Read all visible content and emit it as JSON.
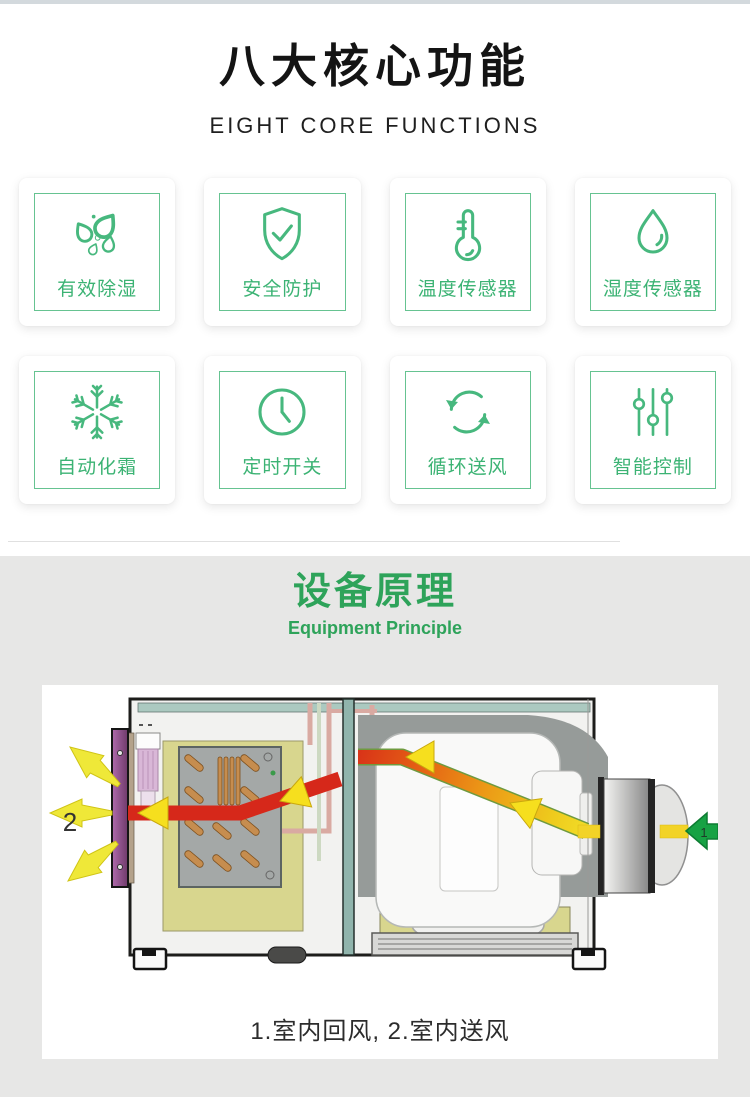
{
  "theme": {
    "accent_green": "#3cb374",
    "icon_stroke_green": "#47b87e",
    "card_border_green": "#66c391",
    "section_title_green": "#2ea35a",
    "top_strip": "#d3d9dd",
    "section_background": "#e7e7e6",
    "heading_color": "#141414",
    "flow_red": "#d6281a",
    "flow_orange": "#ee7f18",
    "flow_yellow": "#f2d327",
    "inlet_arrow_green": "#17a244",
    "louver_purple": "#9a4f96"
  },
  "header": {
    "title": "八大核心功能",
    "subtitle": "EIGHT CORE FUNCTIONS"
  },
  "features": {
    "cards": [
      {
        "icon": "droplets-icon",
        "label": "有效除湿"
      },
      {
        "icon": "shield-check-icon",
        "label": "安全防护"
      },
      {
        "icon": "thermometer-icon",
        "label": "温度传感器"
      },
      {
        "icon": "water-drop-icon",
        "label": "湿度传感器"
      },
      {
        "icon": "snowflake-icon",
        "label": "自动化霜"
      },
      {
        "icon": "clock-icon",
        "label": "定时开关"
      },
      {
        "icon": "cycle-arrows-icon",
        "label": "循环送风"
      },
      {
        "icon": "sliders-icon",
        "label": "智能控制"
      }
    ]
  },
  "principle": {
    "title": "设备原理",
    "subtitle": "Equipment Principle",
    "caption": "1.室内回风, 2.室内送风",
    "marker_return_air": "1",
    "marker_supply_air": "2"
  }
}
